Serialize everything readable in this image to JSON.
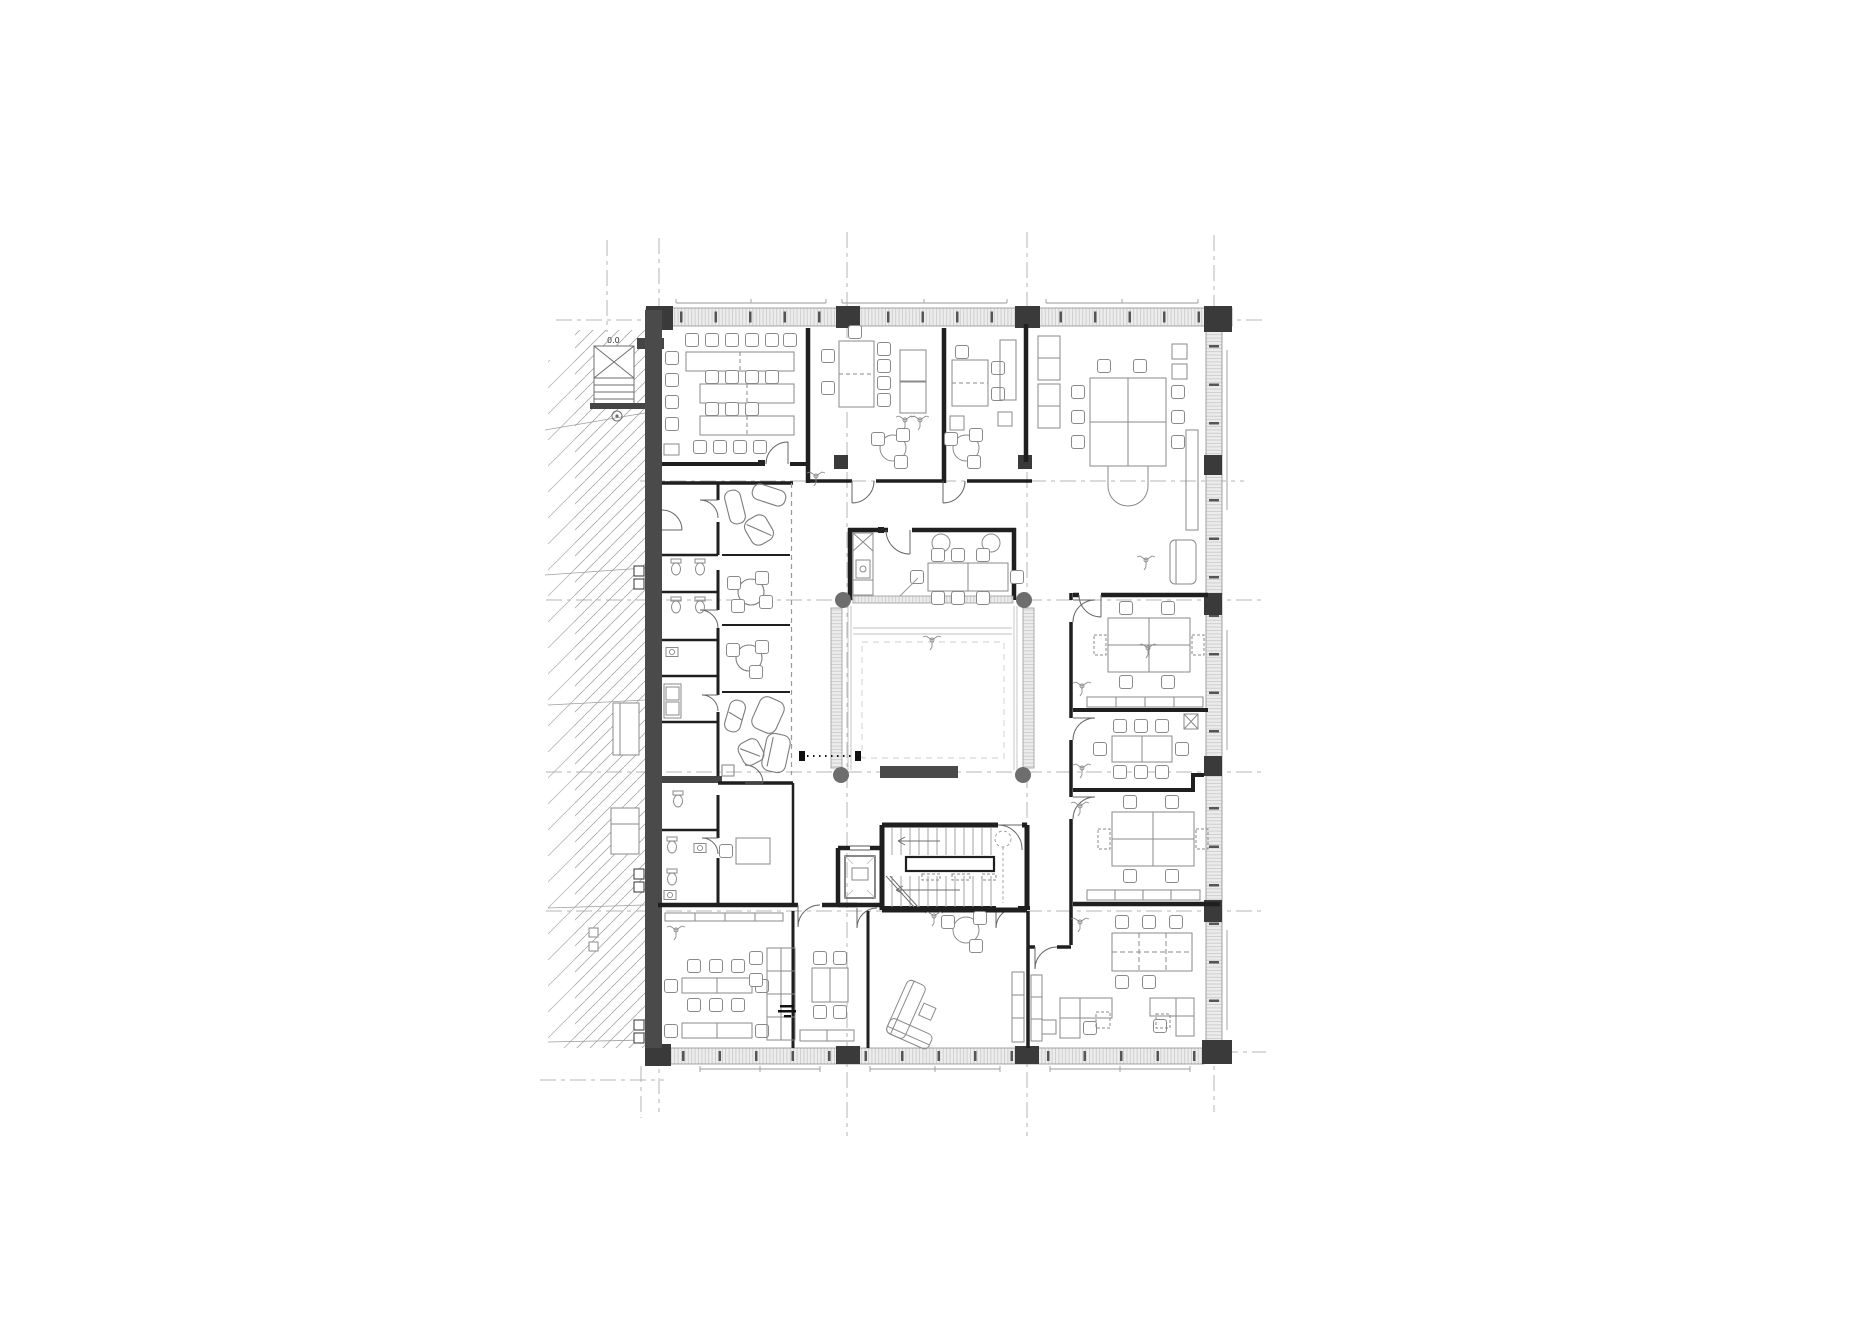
{
  "drawing": {
    "type": "architectural-floor-plan",
    "annotations": {
      "level_label": "0.0"
    },
    "colors": {
      "background": "#ffffff",
      "wall_line": "#1f1f1f",
      "wall_fill": "#454545",
      "column_fill": "#3a3a3a",
      "furniture_line": "#8a8a8a",
      "glazing_fill": "#ebebeb",
      "neighbor_hatch": "#a9a9a9",
      "grid_line": "#b5b5b5"
    },
    "grid": {
      "vertical_axes_x": [
        659,
        847,
        1027,
        1214
      ],
      "horizontal_axes_y": [
        320,
        481,
        600,
        772,
        911,
        1052
      ]
    },
    "rooms": [
      {
        "id": "meeting-room-large",
        "furniture": "3 long tables, 22 chairs"
      },
      {
        "id": "meeting-room-top-1",
        "furniture": "tall table, 7 chairs, cabinets, round table, 2 plants"
      },
      {
        "id": "meeting-room-top-2",
        "furniture": "desk, cabinet, round table, 3 chairs"
      },
      {
        "id": "office-top-right",
        "furniture": "conference table, 10 chairs, cabinets, sideboard, sofa"
      },
      {
        "id": "focus-room-1",
        "furniture": "lounge seating"
      },
      {
        "id": "focus-room-2",
        "furniture": "round table, 4 chairs"
      },
      {
        "id": "focus-room-3",
        "furniture": "round table, 3 chairs"
      },
      {
        "id": "focus-room-4",
        "furniture": "lounge seating"
      },
      {
        "id": "wc-block",
        "furniture": "toilets, sinks"
      },
      {
        "id": "kitchenette",
        "furniture": "counter with sinks"
      },
      {
        "id": "small-office-left",
        "furniture": "desk, chair"
      },
      {
        "id": "reception-lounge",
        "furniture": "kitchen counter, 2 round tables, table with 8 chairs"
      },
      {
        "id": "atrium-void",
        "furniture": "glazed side walls, 4 round columns, bench"
      },
      {
        "id": "stair-core",
        "furniture": "double-flight stair with central rail"
      },
      {
        "id": "elevator",
        "furniture": "elevator car"
      },
      {
        "id": "office-right-1",
        "furniture": "4-desk cluster, sideboard, plant"
      },
      {
        "id": "meeting-room-right",
        "furniture": "conference table, 8 chairs, coat stand"
      },
      {
        "id": "office-right-2",
        "furniture": "4-desk cluster, sideboard, plant"
      },
      {
        "id": "office-bottom-left",
        "furniture": "2 desk clusters, shelving unit"
      },
      {
        "id": "meeting-room-bottom",
        "furniture": "square table, 4 chairs, sideboard"
      },
      {
        "id": "lounge-room-bottom",
        "furniture": "corner sofa, round table, media cabinet"
      },
      {
        "id": "office-bottom-right",
        "furniture": "6-desk row, 2 corner desks, shelving"
      },
      {
        "id": "neighbor-building",
        "furniture": "diagonal hatch, external stair, service boxes"
      }
    ]
  }
}
